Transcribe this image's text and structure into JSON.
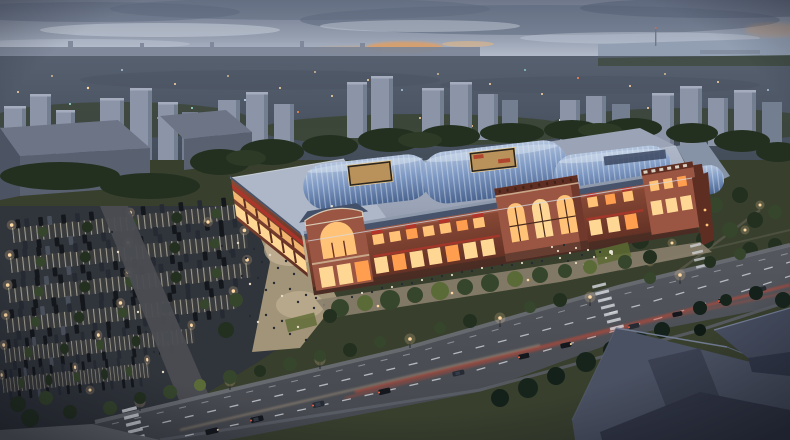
{
  "scene": {
    "type": "architectural-aerial-rendering",
    "subject": "Aerial dusk rendering of a large retail mall complex with wavy blue glass skylight roofs, red-brick facades, plaza crowds, surface parking lot and a boulevard",
    "time_of_day": "dusk",
    "setting": "city outskirts, high-rise apartment skyline and water on the horizon",
    "landmarks": {
      "mall": "two-story brick retail blocks with barrel-vaulted blue skylights, roof courtyards, corner gable entrance and a central three-arch tower",
      "plaza": "west pedestrian plaza crowded with visitors",
      "parking": "tree-lined surface parking lot with lit light poles",
      "road": "wide boulevard with lane dashes, headlight and taillight trails, zebra crosswalks",
      "foreground": "dark rooftops of nearer buildings at bottom right"
    }
  },
  "palette": {
    "sky_top": "#6d7789",
    "sky_mid": "#98a2b3",
    "sky_low": "#c7ceda",
    "cloud_dark": "#59647a",
    "cloud_light": "#d5dbe5",
    "sunset": "#dd9f66",
    "water": "#929fb3",
    "distant": "#7c8698",
    "city_hi": "#56606f",
    "city_lo": "#424b58",
    "twr_face": "#8c95a8",
    "twr_shade": "#747e91",
    "twr_top": "#a4acbe",
    "tree_dark": "#233020",
    "tree_mid": "#36462c",
    "tree_lit": "#5b6b38",
    "shed_front": "#596070",
    "shed_top": "#6d7486",
    "ground": "#383f2d",
    "lawn": "#5c6a33",
    "asphalt": "#30343b",
    "stall": "#b6b1a2",
    "walk": "#4b4d52",
    "plaza": "#a29478",
    "plaza_lit": "#cdbb9e",
    "plaza_pink": "#b1898a",
    "roof_hi": "#aeb7c7",
    "roof_mid": "#9aa4b6",
    "roof_lo": "#8692a5",
    "vault_hi": "#b3c4de",
    "vault_lo": "#4a6490",
    "rib": "#e2eaf5",
    "court_dark": "#2b2620",
    "court_glow": "#d2a565",
    "brick": "#8a4a36",
    "brick_hi": "#9a5642",
    "brick_lo": "#5e2e23",
    "cornice": "#c9a789",
    "sign": "#b5342a",
    "win_warm": "#ffc277",
    "win_bright": "#ffd794",
    "win_deep": "#ff9e4e",
    "arcade_eave": "#46536a",
    "skylight_grid": "#3b4760",
    "road": "#54575e",
    "road_lo": "#44474d",
    "lane": "#d0d4d9",
    "sidewalk": "#6b6e75",
    "tail": "#e0462e",
    "head": "#ffd9a8",
    "car_a": "#14171c",
    "car_b": "#262b33",
    "car_c": "#4a505b",
    "lamp": "#ffd9a2",
    "light_orange": "#ff8a50",
    "light_cyan": "#9fe8dc",
    "light_blue": "#cfe4ff",
    "crowd_d": "#262a32",
    "crowd_l": "#e6dac4",
    "fg_roof": "#4a5162",
    "fg_roof_lo": "#303646",
    "fg_edge": "#717b92"
  }
}
